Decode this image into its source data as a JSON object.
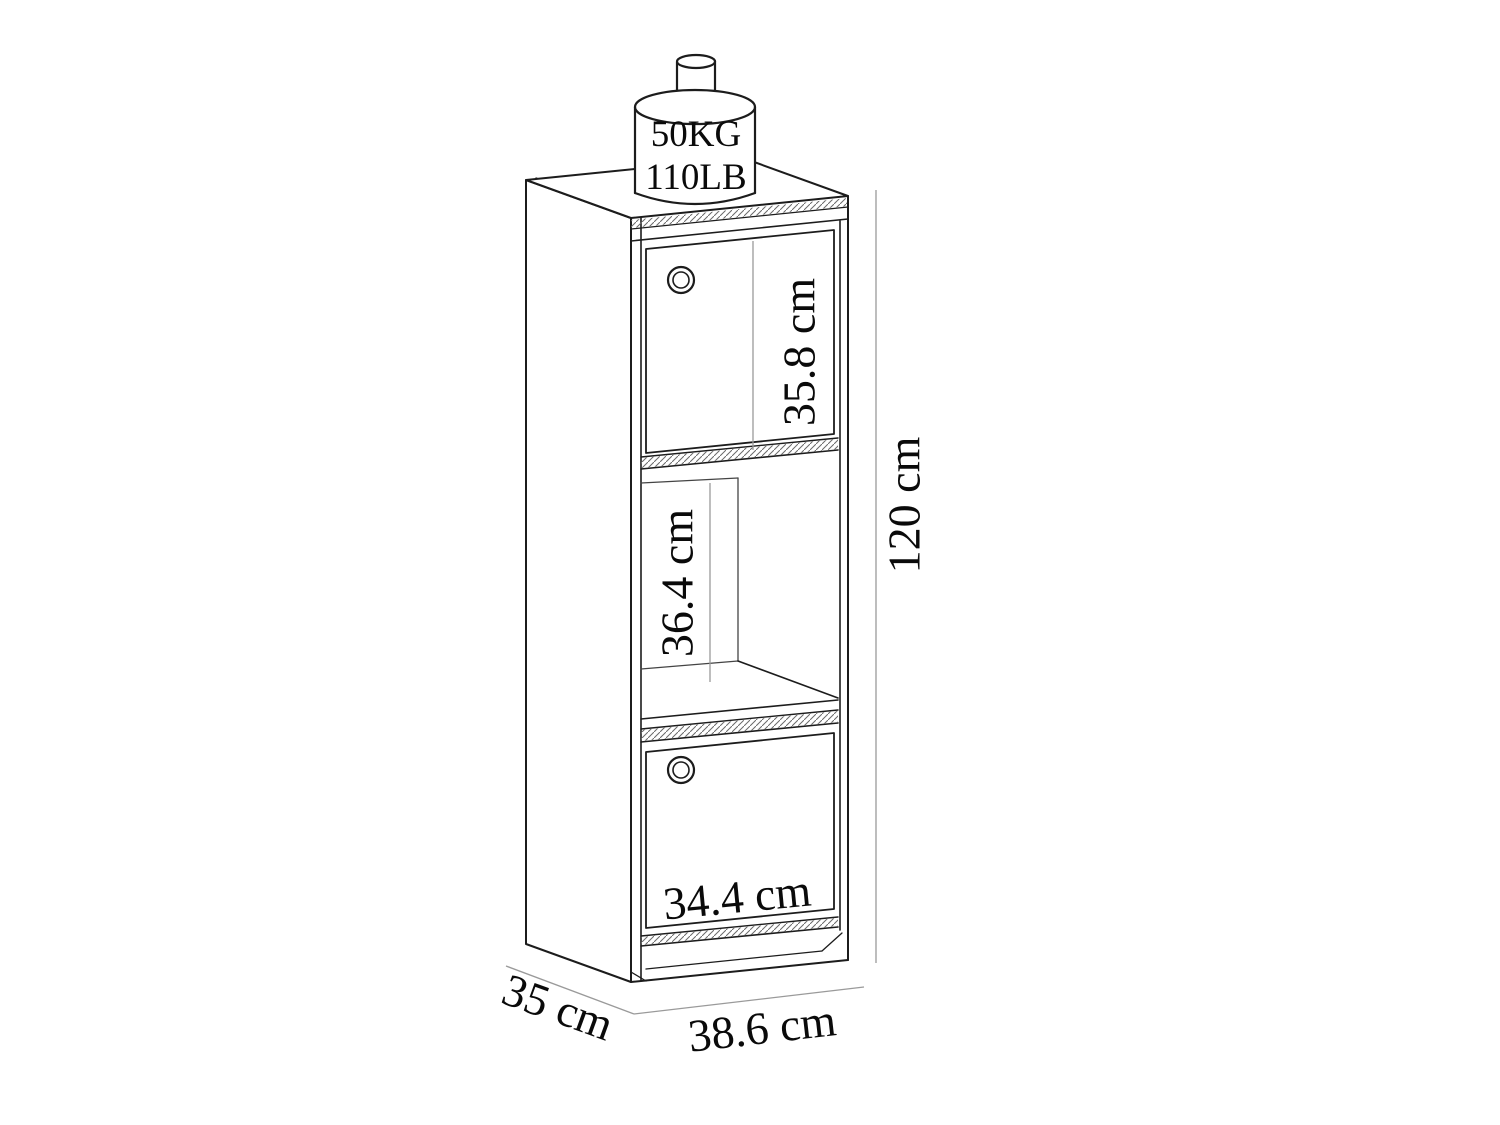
{
  "diagram": {
    "title": "cabinet-dimension-diagram",
    "line_color": "#1c1c1c",
    "thin_line_color": "#555555",
    "dim_line_color": "#9a9a9a",
    "background": "#ffffff"
  },
  "weight": {
    "kg": "50KG",
    "lb": "110LB"
  },
  "dimensions": {
    "top_compartment_height": "35.8 cm",
    "middle_compartment_height": "36.4 cm",
    "bottom_door_width": "34.4 cm",
    "overall_height": "120 cm",
    "depth": "35 cm",
    "overall_width": "38.6 cm"
  }
}
